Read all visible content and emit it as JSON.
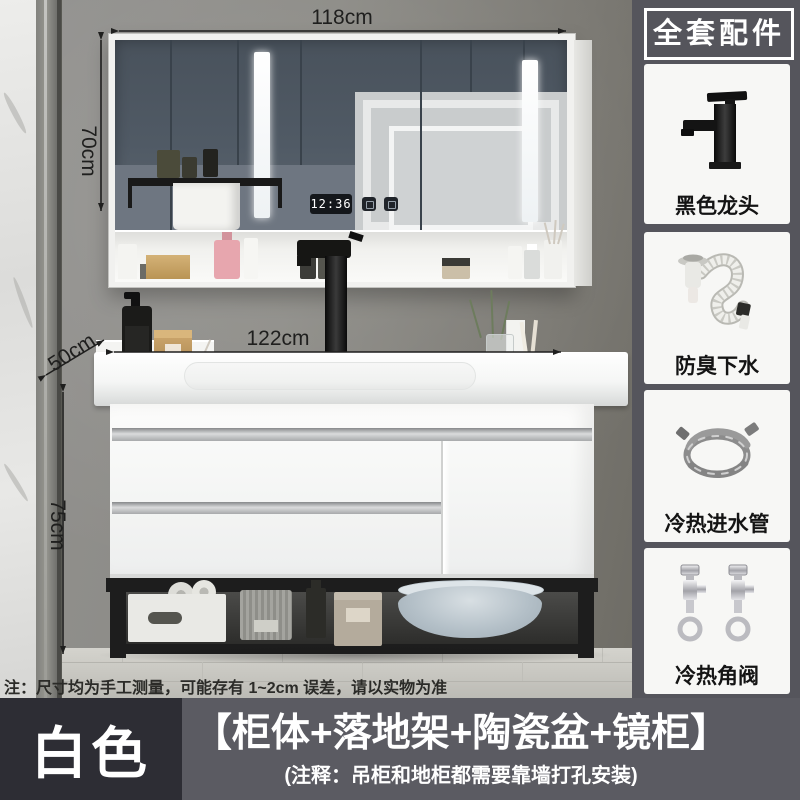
{
  "scene": {
    "clock_time": "12:36",
    "note": "注：尺寸均为手工测量，可能存有 1~2cm 误差，请以实物为准",
    "dimensions": {
      "mirror_width": "118cm",
      "mirror_height": "70cm",
      "counter_width": "122cm",
      "counter_depth": "50cm",
      "cabinet_height": "75cm"
    }
  },
  "accessories_panel": {
    "title": "全套配件",
    "items": [
      {
        "label": "黑色龙头",
        "icon": "black-faucet-icon"
      },
      {
        "label": "防臭下水",
        "icon": "drain-hose-icon"
      },
      {
        "label": "冷热进水管",
        "icon": "inlet-hose-icon"
      },
      {
        "label": "冷热角阀",
        "icon": "angle-valve-icon"
      }
    ]
  },
  "footer": {
    "color_option": "白色",
    "bundle_title": "【柜体+落地架+陶瓷盆+镜柜】",
    "bundle_note": "(注释：吊柜和地柜都需要靠墙打孔安装)"
  },
  "colors": {
    "panel_bg": "#55555c",
    "card_bg": "#f7f7f5",
    "footer_left_bg": "#2d2d34",
    "footer_right_bg": "#5b5b62",
    "annotation_text": "#1f1f1e",
    "mirror_glass": "#4e5862",
    "led_white": "#ffffff",
    "wall": "#8a8984"
  }
}
